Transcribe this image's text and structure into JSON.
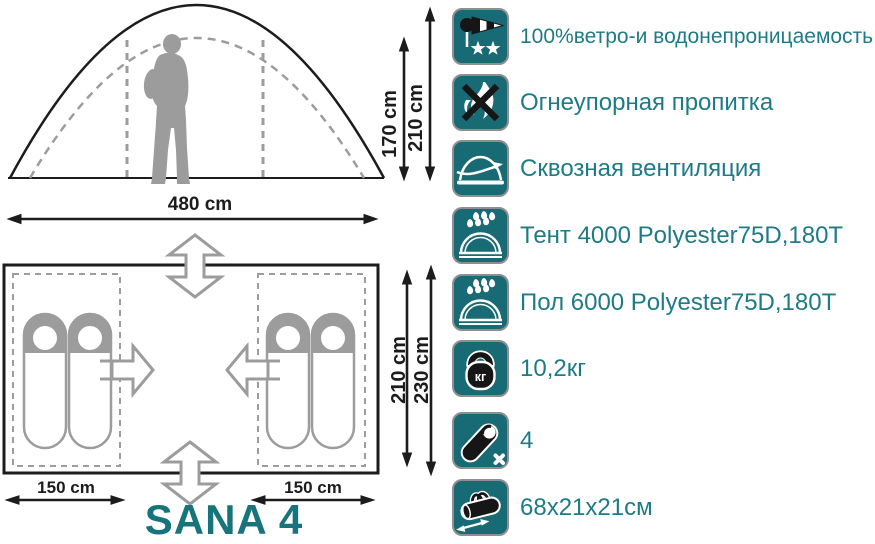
{
  "colors": {
    "teal_icon_bg": "#186b74",
    "teal_text": "#1e7b86",
    "title_teal": "#17737c",
    "diagram_black": "#1c1c1c",
    "diagram_gray": "#9c9c9c",
    "icon_border_gray": "#8f8f8f"
  },
  "model_name": "SANA 4",
  "side_view": {
    "inner_height": "170 cm",
    "outer_height": "210 cm",
    "width": "480 cm"
  },
  "floor_plan": {
    "inner_depth": "210 cm",
    "outer_depth": "230 cm",
    "left_room_width": "150 cm",
    "right_room_width": "150 cm",
    "sleeping_places": 4
  },
  "features": [
    {
      "icon": "windsock-icon",
      "label": "100%ветро-и водонепроницаемость"
    },
    {
      "icon": "no-fire-icon",
      "label": "Огнеупорная пропитка"
    },
    {
      "icon": "ventilation-icon",
      "label": "Сквозная вентиляция"
    },
    {
      "icon": "rainfly-rating-icon",
      "label": "Тент 4000 Polyester75D,180T"
    },
    {
      "icon": "floor-rating-icon",
      "label": "Пол 6000 Polyester75D,180T"
    },
    {
      "icon": "weight-icon",
      "label": "10,2кг",
      "icon_text": "кг"
    },
    {
      "icon": "sleeping-bag-icon",
      "label": "4"
    },
    {
      "icon": "packed-size-icon",
      "label": "68x21x21см"
    }
  ]
}
